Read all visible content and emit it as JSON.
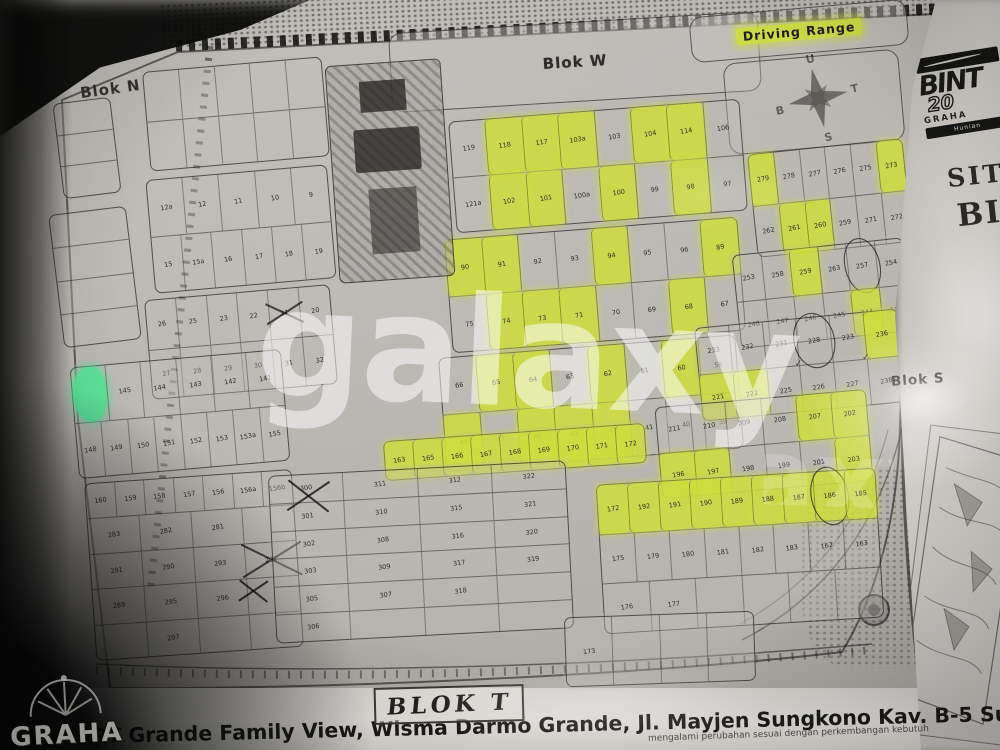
{
  "photo": {
    "watermark": "galaxy",
    "colors": {
      "highlight_yellow": "#cee034",
      "highlight_green": "#56e398",
      "paper": "#b5b2ad",
      "ink": "#232220"
    }
  },
  "map": {
    "labels": {
      "blok_n": "Blok N",
      "blok_w": "Blok W",
      "blok_s": "Blok S",
      "driving_range": "Driving Range"
    },
    "compass": {
      "north": "U",
      "east": "T",
      "south": "S",
      "west": "B"
    },
    "blocks": [
      {
        "id": "block-nw-a",
        "x": 146,
        "y": 64,
        "w": 180,
        "h": 100,
        "rot": -5,
        "rows": [
          [
            "",
            "",
            "",
            "",
            ""
          ],
          [
            "",
            "",
            "",
            "",
            ""
          ]
        ]
      },
      {
        "id": "block-nw-b",
        "x": 150,
        "y": 172,
        "w": 182,
        "h": 114,
        "rot": -5,
        "rows": [
          [
            "12a",
            "12",
            "11",
            "10",
            "9"
          ],
          [
            "15",
            "15a",
            "16",
            "17",
            "18",
            "19"
          ]
        ]
      },
      {
        "id": "block-nw-c",
        "x": 148,
        "y": 292,
        "w": 186,
        "h": 100,
        "rot": -5,
        "rows": [
          [
            "26",
            "25",
            "23",
            "22",
            {
              "n": "21",
              "m": "x"
            },
            "20"
          ],
          [
            "27",
            "28",
            "29",
            "30",
            "31",
            "32"
          ]
        ]
      },
      {
        "id": "block-left-col-a",
        "x": 58,
        "y": 100,
        "w": 58,
        "h": 96,
        "rot": -7,
        "rows": [
          [
            ""
          ],
          [
            ""
          ],
          [
            ""
          ]
        ]
      },
      {
        "id": "block-left-col-b",
        "x": 56,
        "y": 210,
        "w": 78,
        "h": 134,
        "rot": -7,
        "rows": [
          [
            ""
          ],
          [
            ""
          ],
          [
            ""
          ],
          [
            ""
          ]
        ]
      },
      {
        "id": "block-band-a",
        "x": 452,
        "y": 110,
        "w": 292,
        "h": 112,
        "rot": -4.5,
        "rows": [
          [
            "119",
            {
              "n": "118",
              "h": "y"
            },
            {
              "n": "117",
              "h": "y"
            },
            {
              "n": "103a",
              "h": "y"
            },
            "103",
            {
              "n": "104",
              "h": "y"
            },
            {
              "n": "114",
              "h": "y"
            },
            "106"
          ],
          [
            "121a",
            {
              "n": "102",
              "h": "y"
            },
            {
              "n": "101",
              "h": "y"
            },
            "100a",
            {
              "n": "100",
              "h": "y"
            },
            "99",
            {
              "n": "98",
              "h": "y"
            },
            "97"
          ]
        ]
      },
      {
        "id": "block-band-b",
        "x": 448,
        "y": 228,
        "w": 294,
        "h": 114,
        "rot": -4.5,
        "rows": [
          [
            {
              "n": "90",
              "h": "y"
            },
            {
              "n": "91",
              "h": "y"
            },
            "92",
            "93",
            {
              "n": "94",
              "h": "y"
            },
            "95",
            "96",
            {
              "n": "89",
              "h": "y"
            }
          ],
          [
            "75",
            {
              "n": "74",
              "h": "y"
            },
            {
              "n": "73",
              "h": "y"
            },
            {
              "n": "71",
              "h": "y"
            },
            "70",
            "69",
            {
              "n": "68",
              "h": "y"
            },
            "67"
          ]
        ]
      },
      {
        "id": "block-band-c",
        "x": 442,
        "y": 346,
        "w": 298,
        "h": 114,
        "rot": -4.5,
        "rows": [
          [
            "66",
            {
              "n": "65",
              "h": "y"
            },
            {
              "n": "64",
              "h": "y"
            },
            "63",
            {
              "n": "62",
              "h": "y"
            },
            "61",
            {
              "n": "60",
              "h": "y"
            },
            "59"
          ],
          [
            {
              "n": "49",
              "h": "y"
            },
            "47",
            {
              "n": "45",
              "h": "y"
            },
            {
              "n": "43",
              "h": "y"
            },
            {
              "n": "42",
              "h": "y"
            },
            "41",
            "40",
            "39"
          ]
        ]
      },
      {
        "id": "block-band-d",
        "x": 384,
        "y": 432,
        "w": 262,
        "h": 40,
        "rot": -4,
        "rows": [
          [
            {
              "n": "163",
              "h": "y"
            },
            {
              "n": "165",
              "h": "y"
            },
            {
              "n": "166",
              "h": "y"
            },
            {
              "n": "167",
              "h": "y"
            },
            {
              "n": "168",
              "h": "y"
            },
            {
              "n": "169",
              "h": "y"
            },
            {
              "n": "170",
              "h": "y"
            },
            {
              "n": "171",
              "h": "y"
            },
            {
              "n": "172",
              "h": "y"
            }
          ]
        ]
      },
      {
        "id": "block-right-1",
        "x": 752,
        "y": 146,
        "w": 156,
        "h": 104,
        "rot": -6,
        "rows": [
          [
            {
              "n": "279",
              "h": "y"
            },
            "278",
            "277",
            "276",
            "275",
            {
              "n": "273",
              "h": "y"
            }
          ],
          [
            "262",
            {
              "n": "261",
              "h": "y"
            },
            {
              "n": "260",
              "h": "y"
            },
            "259",
            "271",
            "272"
          ]
        ]
      },
      {
        "id": "block-right-2",
        "x": 736,
        "y": 246,
        "w": 172,
        "h": 94,
        "rot": -6,
        "rows": [
          [
            "253",
            "258",
            {
              "n": "259",
              "h": "y"
            },
            "263",
            {
              "n": "257",
              "m": "o"
            },
            "254"
          ],
          [
            "248",
            "247",
            "246",
            "245",
            {
              "n": "244",
              "h": "y"
            },
            "243"
          ]
        ]
      },
      {
        "id": "block-right-3",
        "x": 698,
        "y": 318,
        "w": 204,
        "h": 94,
        "rot": -5.5,
        "rows": [
          [
            "233",
            "232",
            "231",
            {
              "n": "228",
              "m": "o"
            },
            "223",
            {
              "n": "236",
              "h": "y"
            }
          ],
          [
            {
              "n": "221",
              "h": "y"
            },
            {
              "n": "222",
              "h": "y"
            },
            {
              "n": "225",
              "m": "c"
            },
            "226",
            {
              "n": "227",
              "m": "c"
            },
            "238"
          ]
        ]
      },
      {
        "id": "block-right-4",
        "x": 658,
        "y": 398,
        "w": 212,
        "h": 92,
        "rot": -5,
        "rows": [
          [
            "211",
            "210",
            "209",
            "208",
            {
              "n": "207",
              "h": "y"
            },
            {
              "n": "202",
              "h": "y"
            }
          ],
          [
            {
              "n": "196",
              "h": "y"
            },
            {
              "n": "197",
              "h": "y"
            },
            "198",
            "199",
            "201",
            {
              "n": "203",
              "h": "y"
            }
          ]
        ]
      },
      {
        "id": "block-green",
        "x": 74,
        "y": 358,
        "w": 212,
        "h": 112,
        "rot": -5,
        "rows": [
          [
            {
              "n": "",
              "h": "g"
            },
            "145",
            "144",
            "143",
            "142",
            "141"
          ],
          [
            "148",
            "149",
            "150",
            "151",
            "152",
            "153",
            "153a",
            "155"
          ]
        ]
      },
      {
        "id": "block-sw",
        "x": 90,
        "y": 476,
        "w": 208,
        "h": 178,
        "rot": -4,
        "rows": [
          [
            "160",
            "159",
            "158",
            "157",
            "156",
            "156a",
            "156b"
          ],
          [
            "283",
            "282",
            "281",
            ""
          ],
          [
            "291",
            "290",
            "293",
            {
              "n": "292",
              "m": "x"
            }
          ],
          [
            "289",
            "295",
            "296",
            ""
          ],
          [
            "",
            "297",
            "",
            ""
          ]
        ]
      },
      {
        "id": "block-300s",
        "x": 272,
        "y": 468,
        "w": 298,
        "h": 168,
        "rot": -3,
        "rows": [
          [
            "300",
            "311",
            "312",
            "322"
          ],
          [
            "301",
            "310",
            "315",
            "321"
          ],
          [
            "302",
            "308",
            "316",
            "320"
          ],
          [
            "303",
            "309",
            "317",
            "319"
          ],
          [
            "305",
            "307",
            "318",
            ""
          ],
          [
            "306",
            "",
            "",
            ""
          ]
        ]
      },
      {
        "id": "block-se",
        "x": 600,
        "y": 476,
        "w": 280,
        "h": 150,
        "rot": -3.5,
        "rows": [
          [
            {
              "n": "172",
              "h": "y"
            },
            {
              "n": "192",
              "h": "y"
            },
            {
              "n": "191",
              "h": "y"
            },
            {
              "n": "190",
              "h": "y"
            },
            {
              "n": "189",
              "h": "y"
            },
            {
              "n": "188",
              "h": "y"
            },
            {
              "n": "187",
              "h": "y"
            },
            {
              "n": "186",
              "h": "y",
              "m": "o"
            },
            {
              "n": "185",
              "h": "y"
            }
          ],
          [
            "175",
            "179",
            "180",
            "181",
            "182",
            "183",
            "162",
            "163"
          ],
          [
            "176",
            "177",
            "",
            "",
            "",
            ""
          ]
        ]
      },
      {
        "id": "block-s-mid",
        "x": 565,
        "y": 614,
        "w": 190,
        "h": 70,
        "rot": -2,
        "rows": [
          [
            "173",
            "",
            "",
            ""
          ]
        ]
      }
    ],
    "pen_marks": [
      {
        "x": 287,
        "y": 474,
        "s": 44
      },
      {
        "x": 238,
        "y": 576,
        "s": 30
      }
    ]
  },
  "side_page": {
    "logo_title": "BINT",
    "logo_year": "20",
    "logo_sub": "GRAHA",
    "logo_banner": "Hunian",
    "site_label": "SITE",
    "blok_label": "BI"
  },
  "logo_graha": {
    "text": "GRAHA"
  },
  "footer": {
    "handwritten": "BLOK T",
    "title": "PT Grande Family View, Wisma Darmo Grande, Jl. Mayjen Sungkono Kav. B-5 Surabaya",
    "disclaimer": "mengalami perubahan sesuai dengan perkembangan kebutuh"
  }
}
